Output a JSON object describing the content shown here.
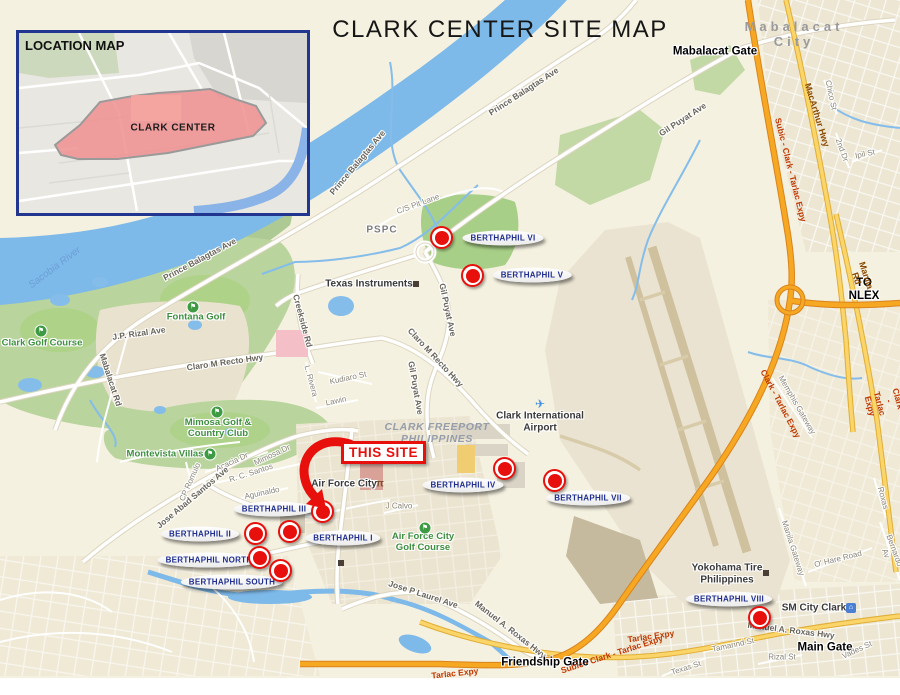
{
  "title": "CLARK CENTER SITE MAP",
  "inset": {
    "title": "LOCATION MAP",
    "area_label": "CLARK CENTER"
  },
  "this_site": {
    "label": "THIS SITE"
  },
  "colors": {
    "marker_red": "#e21212",
    "label_navy": "#1f2e8e",
    "this_site_red": "#e8100c",
    "expressway_orange": "#f7a823",
    "highway_yellow": "#fbd56a",
    "water_blue": "#7db9e9",
    "land_cream": "#f5f1e0"
  },
  "sites": [
    {
      "name": "BERTHAPHIL VI",
      "mx": 442,
      "my": 238,
      "lx": 503,
      "ly": 238
    },
    {
      "name": "BERTHAPHIL V",
      "mx": 473,
      "my": 276,
      "lx": 532,
      "ly": 275
    },
    {
      "name": "BERTHAPHIL IV",
      "mx": 505,
      "my": 469,
      "lx": 463,
      "ly": 485
    },
    {
      "name": "BERTHAPHIL VII",
      "mx": 555,
      "my": 481,
      "lx": 588,
      "ly": 498
    },
    {
      "name": "BERTHAPHIL III",
      "mx": 323,
      "my": 512,
      "lx": 274,
      "ly": 509
    },
    {
      "name": "BERTHAPHIL II",
      "mx": 256,
      "my": 534,
      "lx": 200,
      "ly": 534
    },
    {
      "name": "BERTHAPHIL I",
      "mx": 290,
      "my": 532,
      "lx": 343,
      "ly": 538
    },
    {
      "name": "BERTHAPHIL NORTH",
      "mx": 260,
      "my": 558,
      "lx": 209,
      "ly": 560
    },
    {
      "name": "BERTHAPHIL SOUTH",
      "mx": 281,
      "my": 571,
      "lx": 232,
      "ly": 582
    },
    {
      "name": "BERTHAPHIL VIII",
      "mx": 760,
      "my": 618,
      "lx": 729,
      "ly": 599
    }
  ],
  "map_labels": [
    {
      "text": "Mabalacat City",
      "x": 794,
      "y": 35,
      "rot": 0,
      "cls": "city"
    },
    {
      "text": "Mabalacat Gate",
      "x": 715,
      "y": 52,
      "rot": 0,
      "cls": "gate halo"
    },
    {
      "text": "MacArthur Hwy",
      "x": 817,
      "y": 115,
      "rot": 73,
      "cls": "hwy"
    },
    {
      "text": "Chico St",
      "x": 831,
      "y": 95,
      "rot": 78,
      "cls": "street halo"
    },
    {
      "text": "2nd Dr",
      "x": 842,
      "y": 150,
      "rot": 70,
      "cls": "street halo"
    },
    {
      "text": "Ipil St",
      "x": 865,
      "y": 154,
      "rot": -12,
      "cls": "street halo"
    },
    {
      "text": "Subic - Clark - Tarlac Expy",
      "x": 790,
      "y": 170,
      "rot": 76,
      "cls": "expy"
    },
    {
      "text": "TO NLEX",
      "x": 864,
      "y": 290,
      "rot": 0,
      "cls": "gate halo"
    },
    {
      "text": "Manila Rd",
      "x": 861,
      "y": 277,
      "rot": 72,
      "cls": "hwy"
    },
    {
      "text": "Clark - Tarlac Expy",
      "x": 780,
      "y": 404,
      "rot": 62,
      "cls": "expy"
    },
    {
      "text": "Memphis Gateway",
      "x": 797,
      "y": 405,
      "rot": 60,
      "cls": "street halo"
    },
    {
      "text": "Subic - Clark - Tarlac Expy",
      "x": 893,
      "y": 400,
      "rot": 75,
      "cls": "expy"
    },
    {
      "text": "Sacobia River",
      "x": 55,
      "y": 268,
      "rot": -37,
      "cls": "water"
    },
    {
      "text": "Prince Balagtas Ave",
      "x": 200,
      "y": 260,
      "rot": -28,
      "cls": "road halo"
    },
    {
      "text": "Prince Balagtas Ave",
      "x": 524,
      "y": 92,
      "rot": -33,
      "cls": "road halo"
    },
    {
      "text": "Prince Balagtas Ave",
      "x": 358,
      "y": 163,
      "rot": -50,
      "cls": "road halo"
    },
    {
      "text": "Clark Golf Course",
      "x": 42,
      "y": 344,
      "rot": 0,
      "cls": "green halo"
    },
    {
      "text": "Fontana Golf",
      "x": 196,
      "y": 318,
      "rot": 0,
      "cls": "green halo"
    },
    {
      "text": "J.P. Rizal Ave",
      "x": 139,
      "y": 334,
      "rot": -8,
      "cls": "road halo"
    },
    {
      "text": "Mabalacat Rd",
      "x": 110,
      "y": 380,
      "rot": 72,
      "cls": "road halo"
    },
    {
      "text": "Claro M Recto Hwy",
      "x": 225,
      "y": 363,
      "rot": -8,
      "cls": "road halo"
    },
    {
      "text": "Claro M Recto Hwy",
      "x": 435,
      "y": 358,
      "rot": 47,
      "cls": "road halo"
    },
    {
      "text": "Creekside Rd",
      "x": 302,
      "y": 321,
      "rot": 75,
      "cls": "road halo"
    },
    {
      "text": "C/S Pit Lane",
      "x": 418,
      "y": 204,
      "rot": -20,
      "cls": "street halo"
    },
    {
      "text": "PSPC",
      "x": 382,
      "y": 230,
      "rot": 0,
      "cls": "poi-gray halo"
    },
    {
      "text": "Texas Instruments",
      "x": 369,
      "y": 284,
      "rot": 0,
      "cls": "poi halo"
    },
    {
      "text": "Gil Puyat Ave",
      "x": 683,
      "y": 120,
      "rot": -33,
      "cls": "road halo"
    },
    {
      "text": "Gil Puyat Ave",
      "x": 447,
      "y": 310,
      "rot": 78,
      "cls": "road halo"
    },
    {
      "text": "Gil Puyat Ave",
      "x": 415,
      "y": 388,
      "rot": 80,
      "cls": "road halo"
    },
    {
      "text": "Kudiaro St",
      "x": 348,
      "y": 378,
      "rot": -12,
      "cls": "street halo"
    },
    {
      "text": "L. Rivera",
      "x": 311,
      "y": 381,
      "rot": 75,
      "cls": "street halo"
    },
    {
      "text": "Lawin",
      "x": 336,
      "y": 401,
      "rot": -12,
      "cls": "street halo"
    },
    {
      "text": "CLARK FREEPORT\nPHILIPPINES",
      "x": 437,
      "y": 433,
      "rot": 0,
      "cls": "district"
    },
    {
      "text": "Clark International\nAirport",
      "x": 540,
      "y": 422,
      "rot": 0,
      "cls": "poi halo"
    },
    {
      "text": "Mimosa Golf &\nCountry Club",
      "x": 218,
      "y": 429,
      "rot": 0,
      "cls": "green halo"
    },
    {
      "text": "Montevista Villas",
      "x": 165,
      "y": 455,
      "rot": 0,
      "cls": "green halo"
    },
    {
      "text": "Acacia Dr",
      "x": 232,
      "y": 462,
      "rot": -25,
      "cls": "street halo"
    },
    {
      "text": "Mimosa Dr",
      "x": 272,
      "y": 455,
      "rot": -25,
      "cls": "street halo"
    },
    {
      "text": "R. C. Santos",
      "x": 251,
      "y": 473,
      "rot": -18,
      "cls": "street halo"
    },
    {
      "text": "CP Romulo",
      "x": 190,
      "y": 482,
      "rot": -66,
      "cls": "street halo"
    },
    {
      "text": "Jose Abad Santos Ave",
      "x": 193,
      "y": 498,
      "rot": -40,
      "cls": "road halo"
    },
    {
      "text": "Aguinaldo",
      "x": 262,
      "y": 493,
      "rot": -12,
      "cls": "street halo"
    },
    {
      "text": "Air Force City",
      "x": 344,
      "y": 484,
      "rot": 0,
      "cls": "poi halo"
    },
    {
      "text": "J Calvo",
      "x": 399,
      "y": 506,
      "rot": 0,
      "cls": "street halo"
    },
    {
      "text": "Air Force City\nGolf Course",
      "x": 423,
      "y": 543,
      "rot": 0,
      "cls": "green halo"
    },
    {
      "text": "Jose P Laurel Ave",
      "x": 423,
      "y": 595,
      "rot": 18,
      "cls": "road halo"
    },
    {
      "text": "Manuel A. Roxas Hwy",
      "x": 510,
      "y": 630,
      "rot": 38,
      "cls": "road halo"
    },
    {
      "text": "Manuel A. Roxas Hwy",
      "x": 791,
      "y": 631,
      "rot": 7,
      "cls": "road halo"
    },
    {
      "text": "Friendship Gate",
      "x": 545,
      "y": 663,
      "rot": 0,
      "cls": "gate halo"
    },
    {
      "text": "Subic - Clark - Tarlac Expy",
      "x": 612,
      "y": 655,
      "rot": -18,
      "cls": "expy"
    },
    {
      "text": "Tarlac Expy",
      "x": 651,
      "y": 637,
      "rot": -8,
      "cls": "expy"
    },
    {
      "text": "Tarlac Expy",
      "x": 455,
      "y": 674,
      "rot": -6,
      "cls": "expy"
    },
    {
      "text": "Tamarind St",
      "x": 733,
      "y": 645,
      "rot": -12,
      "cls": "street halo"
    },
    {
      "text": "Rizal St",
      "x": 782,
      "y": 657,
      "rot": 0,
      "cls": "street halo"
    },
    {
      "text": "Texas St",
      "x": 686,
      "y": 668,
      "rot": -18,
      "cls": "street halo"
    },
    {
      "text": "Main Gate",
      "x": 825,
      "y": 648,
      "rot": 0,
      "cls": "gate halo"
    },
    {
      "text": "Vades St",
      "x": 857,
      "y": 650,
      "rot": -25,
      "cls": "street halo"
    },
    {
      "text": "Yokohama Tire\nPhilippines",
      "x": 727,
      "y": 574,
      "rot": 0,
      "cls": "poi halo"
    },
    {
      "text": "SM City Clark",
      "x": 814,
      "y": 608,
      "rot": 0,
      "cls": "poi halo"
    },
    {
      "text": "O' Hare Road",
      "x": 838,
      "y": 559,
      "rot": -14,
      "cls": "street halo"
    },
    {
      "text": "Manila Gateway",
      "x": 793,
      "y": 548,
      "rot": 72,
      "cls": "street halo"
    },
    {
      "text": "Roxas",
      "x": 883,
      "y": 498,
      "rot": 75,
      "cls": "street halo"
    },
    {
      "text": "Bernardo Av",
      "x": 890,
      "y": 552,
      "rot": 70,
      "cls": "street halo"
    }
  ],
  "icons": [
    {
      "t": "golf",
      "x": 41,
      "y": 331
    },
    {
      "t": "golf",
      "x": 193,
      "y": 307
    },
    {
      "t": "golf",
      "x": 217,
      "y": 412
    },
    {
      "t": "golf",
      "x": 210,
      "y": 454
    },
    {
      "t": "golf",
      "x": 425,
      "y": 528
    },
    {
      "t": "plane",
      "x": 540,
      "y": 404
    },
    {
      "t": "torii",
      "x": 380,
      "y": 484
    },
    {
      "t": "sq",
      "x": 416,
      "y": 284
    },
    {
      "t": "sq",
      "x": 766,
      "y": 573
    },
    {
      "t": "sq",
      "x": 341,
      "y": 563
    },
    {
      "t": "mall",
      "x": 851,
      "y": 608
    }
  ]
}
